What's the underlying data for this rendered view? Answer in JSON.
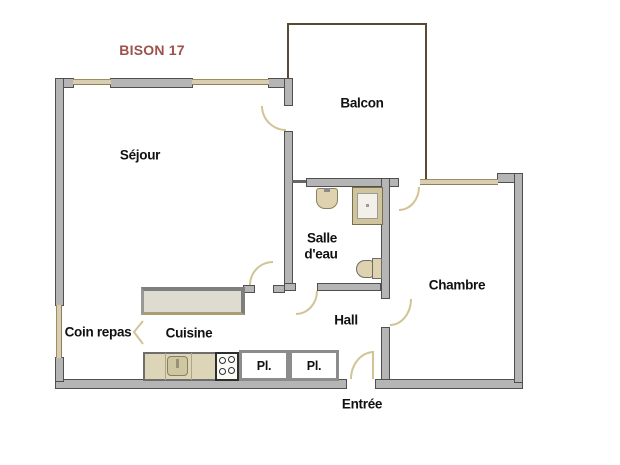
{
  "title": {
    "text": "BISON 17",
    "color": "#9c524a"
  },
  "rooms": {
    "sejour": {
      "label": "Séjour"
    },
    "balcon": {
      "label": "Balcon"
    },
    "salle_eau": {
      "label_line1": "Salle",
      "label_line2": "d'eau"
    },
    "chambre": {
      "label": "Chambre"
    },
    "hall": {
      "label": "Hall"
    },
    "cuisine": {
      "label": "Cuisine"
    },
    "coin_repas": {
      "label": "Coin repas"
    },
    "entree": {
      "label": "Entrée"
    }
  },
  "closets": {
    "placard_left": "Pl.",
    "placard_right": "Pl."
  },
  "fixtures": [
    "washbasin",
    "shower",
    "toilet",
    "kitchen-sink",
    "cooktop",
    "counter"
  ],
  "colors": {
    "background": "#ffffff",
    "wall_fill": "#b5b5b5",
    "wall_outline": "#4f4f4f",
    "window_fill": "#d9ceb2",
    "window_edge": "#a08c5e",
    "balcony_outline": "#5a4a33",
    "door_arc": "#d2c397",
    "fixture_fill": "#ded3ae",
    "counter_fill": "#dedbd0",
    "title_text": "#9c524a",
    "label_text": "#111111"
  }
}
